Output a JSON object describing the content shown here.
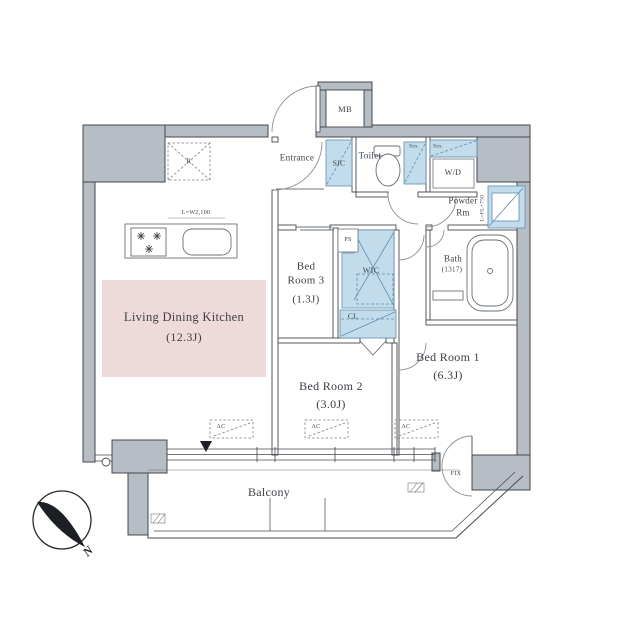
{
  "plan": {
    "rooms": {
      "ldk": {
        "label": "Living Dining Kitchen",
        "size": "(12.3J)"
      },
      "bedroom1": {
        "label": "Bed Room 1",
        "size": "(6.3J)"
      },
      "bedroom2": {
        "label": "Bed Room 2",
        "size": "(3.0J)"
      },
      "bedroom3": {
        "label_line1": "Bed",
        "label_line2": "Room 3",
        "size": "(1.3J)"
      },
      "bath": {
        "label": "Bath",
        "size": "(1317)"
      },
      "powder_room": {
        "label_line1": "Powder",
        "label_line2": "Rm"
      },
      "toilet": {
        "label": "Toilet"
      },
      "entrance": {
        "label": "Entrance"
      },
      "balcony": {
        "label": "Balcony"
      }
    },
    "compartments": {
      "mb": "MB",
      "sic": "SIC",
      "wic": "WIC",
      "cl": "CL",
      "ps": "PS",
      "wd": "W/D",
      "shelf": "Stn.",
      "refrigerator": "R"
    },
    "annotations": {
      "kitchen_counter": "L=W2,100",
      "washstand": "L=FL+750",
      "fix_window": "FIX",
      "ac": "AC",
      "north": "N"
    },
    "colors": {
      "wall_gray": "#b7bdc5",
      "fixture_blue": "#c3dcec",
      "ldk_pink": "#eedbd9",
      "line": "#43474d"
    }
  }
}
